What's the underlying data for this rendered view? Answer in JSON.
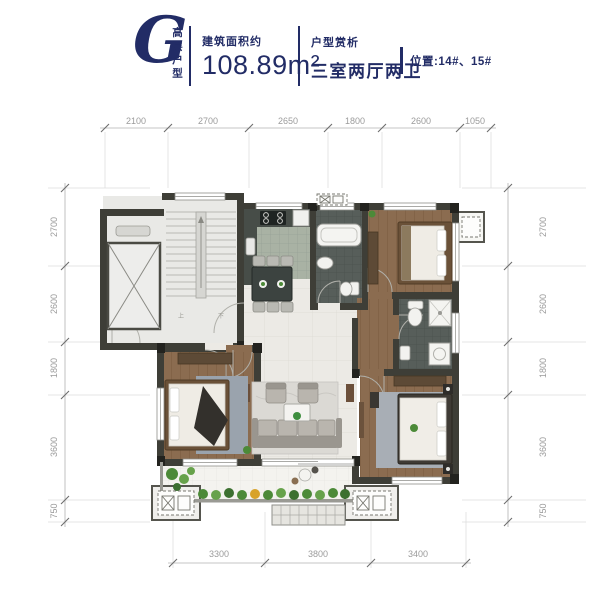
{
  "header": {
    "letter": "G",
    "series_vertical": "高层户型",
    "area_label": "建筑面积约",
    "area_value": "108.89m²",
    "review_label": "户型赏析",
    "layout_value": "三室两厅两卫",
    "location": "位置:14#、15#"
  },
  "dimensions": {
    "top": [
      "2100",
      "2700",
      "2650",
      "1800",
      "2600",
      "1050"
    ],
    "left": [
      "2700",
      "2600",
      "1800",
      "3600",
      "750"
    ],
    "right": [
      "2700",
      "2600",
      "1800",
      "3600",
      "750"
    ],
    "bottom": [
      "3300",
      "3800",
      "3400"
    ]
  },
  "plan": {
    "stairs_up_label": "上",
    "stairs_down_label": "下"
  },
  "colors": {
    "navy": "#222c66",
    "dim_text": "#9b9b9b",
    "wall": "#3e3e37",
    "wood": "#8b6c50",
    "kitchen_tile": "#a9b2a4",
    "bath_tile": "#565d59",
    "living_tile": "#eceae5",
    "rug_blue": "#9aa3ad",
    "plant_green": "#4c8a38",
    "white_fixture": "#f2f2ef"
  }
}
